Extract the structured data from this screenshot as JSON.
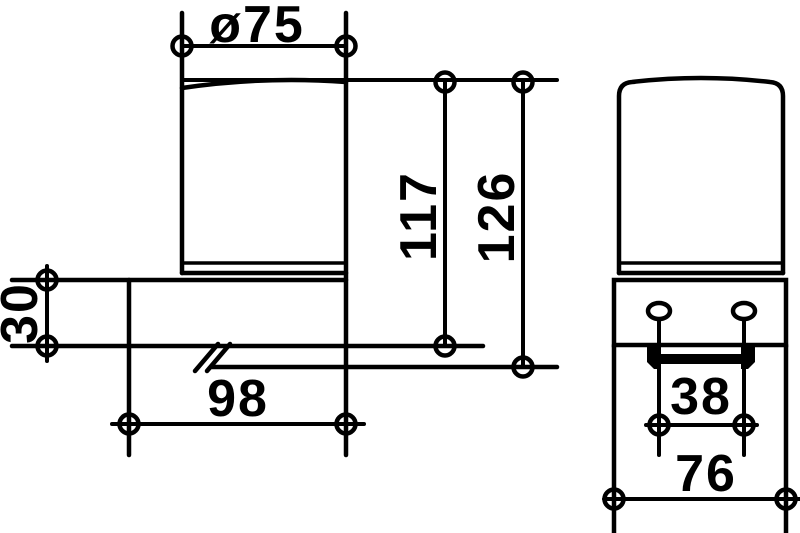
{
  "drawing": {
    "type": "technical-dimension-drawing",
    "background_color": "#ffffff",
    "line_color": "#000000",
    "front_view": {
      "dimensions": {
        "diameter": {
          "label": "ø75",
          "value": 75
        },
        "height_inner": {
          "label": "117",
          "value": 117
        },
        "height_overall": {
          "label": "126",
          "value": 126
        },
        "bracket_height": {
          "label": "30",
          "value": 30
        },
        "width": {
          "label": "98",
          "value": 98
        }
      }
    },
    "side_view": {
      "dimensions": {
        "hole_spacing": {
          "label": "38",
          "value": 38
        },
        "bracket_width": {
          "label": "76",
          "value": 76
        }
      }
    }
  }
}
